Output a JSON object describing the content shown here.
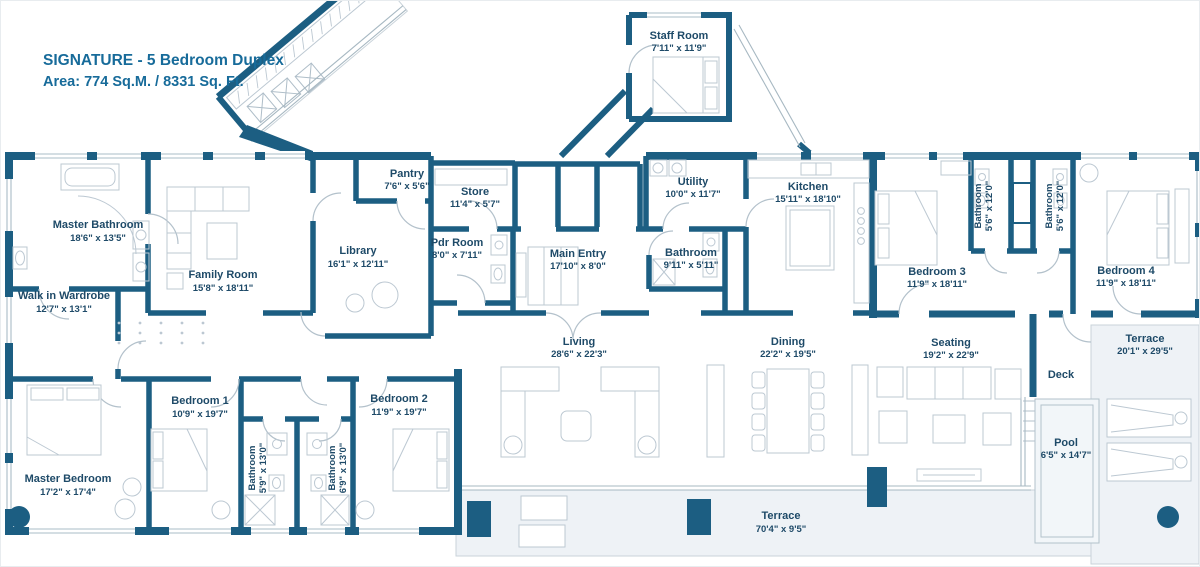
{
  "title": {
    "line1": "SIGNATURE - 5 Bedroom Duplex",
    "line2": "Area: 774 Sq.M. / 8331 Sq. Ft."
  },
  "colors": {
    "wall": "#1c5e82",
    "label_text": "#1e4a68",
    "title_text": "#176b9a",
    "terrace_tint": "#eef2f6",
    "pool_water": "#f2f6f9"
  },
  "rooms": [
    {
      "name": "Master Bathroom",
      "dims": "18'6\" x 13'5\""
    },
    {
      "name": "Family Room",
      "dims": "15'8\" x 18'11\""
    },
    {
      "name": "Walk in Wardrobe",
      "dims": "12'7\" x 13'1\""
    },
    {
      "name": "Library",
      "dims": "16'1\" x 12'11\""
    },
    {
      "name": "Pantry",
      "dims": "7'6\" x 5'6\""
    },
    {
      "name": "Store",
      "dims": "11'4\" x 5'7\""
    },
    {
      "name": "Pdr Room",
      "dims": "8'0\" x 7'11\""
    },
    {
      "name": "Main Entry",
      "dims": "17'10\" x 8'0\""
    },
    {
      "name": "Staff Room",
      "dims": "7'11\" x 11'9\""
    },
    {
      "name": "Utility",
      "dims": "10'0\" x 11'7\""
    },
    {
      "name": "Bathroom",
      "dims": "9'11\" x 5'11\""
    },
    {
      "name": "Kitchen",
      "dims": "15'11\" x 18'10\""
    },
    {
      "name": "Bedroom 3",
      "dims": "11'9\" x 18'11\""
    },
    {
      "name": "Bathroom",
      "dims": "5'6\" x 12'0\""
    },
    {
      "name": "Bathroom",
      "dims": "5'6\" x 12'0\""
    },
    {
      "name": "Bedroom 4",
      "dims": "11'9\" x 18'11\""
    },
    {
      "name": "Living",
      "dims": "28'6\" x 22'3\""
    },
    {
      "name": "Dining",
      "dims": "22'2\" x 19'5\""
    },
    {
      "name": "Seating",
      "dims": "19'2\" x 22'9\""
    },
    {
      "name": "Terrace",
      "dims": "20'1\" x 29'5\""
    },
    {
      "name": "Deck",
      "dims": ""
    },
    {
      "name": "Pool",
      "dims": "6'5\" x 14'7\""
    },
    {
      "name": "Master Bedroom",
      "dims": "17'2\" x 17'4\""
    },
    {
      "name": "Bedroom 1",
      "dims": "10'9\" x 19'7\""
    },
    {
      "name": "Bathroom",
      "dims": "5'9\" x 13'0\""
    },
    {
      "name": "Bathroom",
      "dims": "6'9\" x 13'0\""
    },
    {
      "name": "Bedroom 2",
      "dims": "11'9\" x 19'7\""
    },
    {
      "name": "Terrace",
      "dims": "70'4\" x 9'5\""
    }
  ]
}
